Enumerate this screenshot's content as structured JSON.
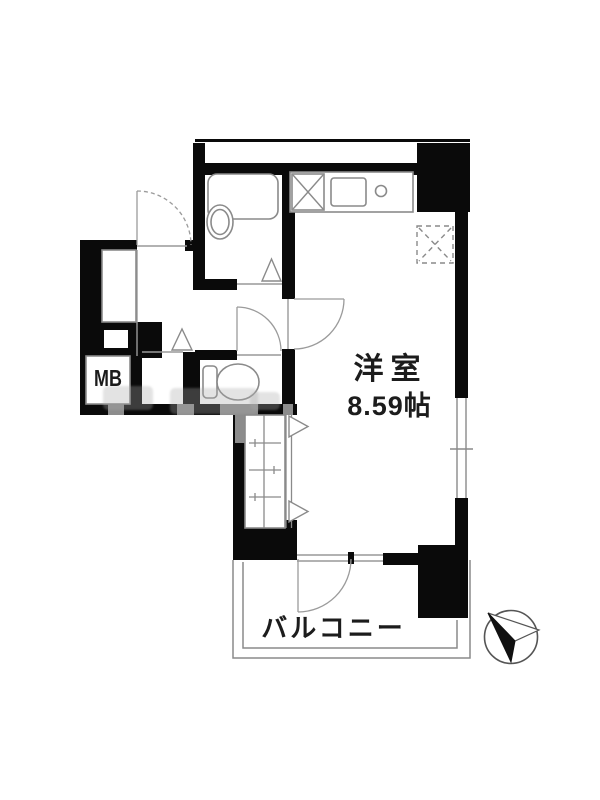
{
  "plan": {
    "room": {
      "name": "洋室",
      "size": "8.59帖"
    },
    "balcony_label": "バルコニー",
    "meter_box_label": "MB",
    "icons": {
      "compass": "north-arrow-icon",
      "door_swings": "door-arc",
      "opening_markers": "triangle-opening-marker"
    },
    "colors": {
      "wall": "#0a0a0a",
      "fixture_line": "#8a8a8a",
      "background": "#ffffff",
      "text": "#1c1c1c"
    }
  }
}
